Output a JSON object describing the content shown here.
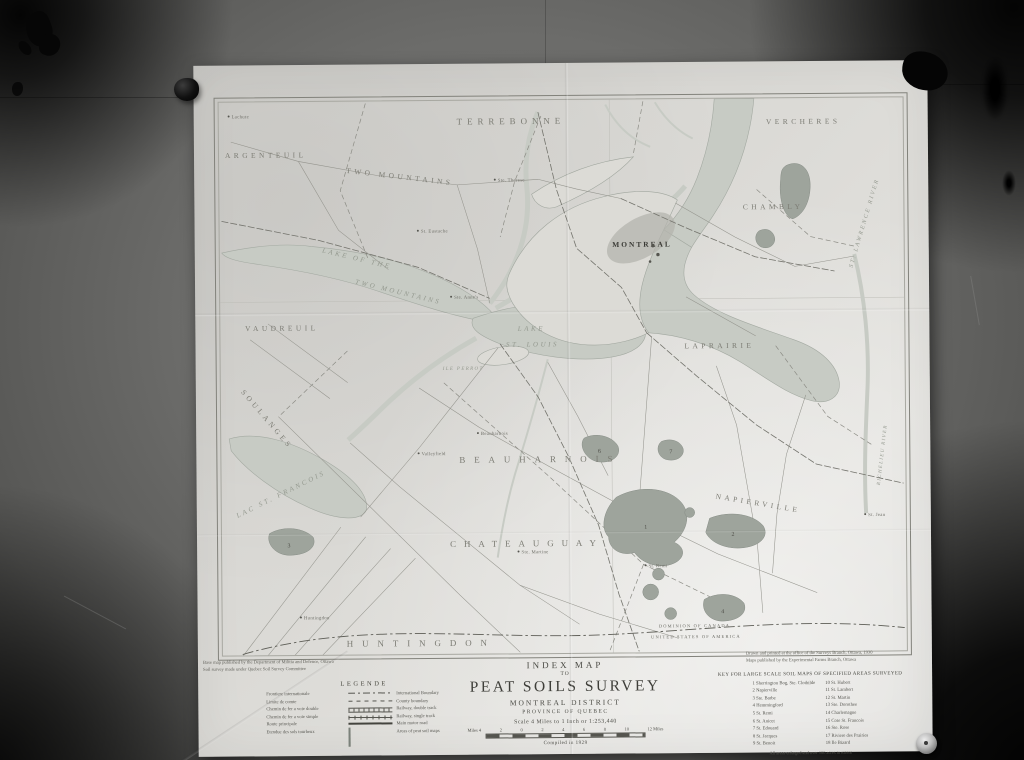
{
  "photo": {
    "wall_color": "#6c6c6a",
    "paper_color": "#dbdad6",
    "water_color": "#c7cbc4",
    "bog_color": "#9ea49c",
    "ink_color": "#4c4c46"
  },
  "map": {
    "labels": {
      "terrebonne": "TERREBONNE",
      "vercheres": "VERCHERES",
      "argenteuil": "ARGENTEUIL",
      "two_mountains": "TWO MOUNTAINS",
      "chambly": "CHAMBLY",
      "laprairie": "LAPRAIRIE",
      "vaudreuil": "VAUDREUIL",
      "soulanges": "SOULANGES",
      "beauharnois": "BEAUHARNOIS",
      "chateauguay": "CHATEAUGUAY",
      "huntingdon": "HUNTINGDON",
      "napierville": "NAPIERVILLE",
      "lake_two_mountains_1": "LAKE OF THE",
      "lake_two_mountains_2": "TWO MOUNTAINS",
      "lake_st_louis_1": "LAKE",
      "lake_st_louis_2": "ST. LOUIS",
      "lac_st_francois": "LAC ST. FRANCOIS",
      "ile_perrot": "ILE PERROT",
      "st_lawrence_river": "ST. LAWRENCE RIVER",
      "richelieu_river": "RICHELIEU RIVER",
      "montreal": "MONTREAL",
      "boundary_north": "DOMINION OF CANADA",
      "boundary_south": "UNITED STATES OF AMERICA"
    },
    "towns": [
      "Lachute",
      "Ste. Therese",
      "St. Eustache",
      "Ste. Anne's",
      "Valleyfield",
      "Beauharnois",
      "Ste. Martine",
      "Huntingdon",
      "St. Remi",
      "St. Jean"
    ],
    "bog_numbers": [
      "1",
      "2",
      "3",
      "4",
      "6",
      "7"
    ]
  },
  "title_block": {
    "line1": "INDEX MAP",
    "line2": "TO",
    "line3": "PEAT SOILS SURVEY",
    "line4": "MONTREAL DISTRICT",
    "line5": "PROVINCE OF QUEBEC",
    "scale_text": "Scale 4 Miles to 1 Inch or 1:253,440",
    "scale_left": "Miles 4",
    "scale_ticks": [
      "2",
      "0",
      "2",
      "4",
      "6",
      "8",
      "10"
    ],
    "scale_right": "12 Miles",
    "compiled": "Compiled in 1929"
  },
  "legend": {
    "title": "LEGENDE",
    "rows": [
      {
        "fr": "Frontiere internationale",
        "en": "International Boundary"
      },
      {
        "fr": "Limite de comte",
        "en": "County boundary"
      },
      {
        "fr": "Chemin de fer a voie double",
        "en": "Railway, double track"
      },
      {
        "fr": "Chemin de fer a voie simple",
        "en": "Railway, single track"
      },
      {
        "fr": "Route principale",
        "en": "Main motor road"
      },
      {
        "fr": "Etendue des sols tourbeux",
        "en": "Areas of peat soil maps"
      }
    ]
  },
  "key": {
    "title": "KEY FOR LARGE SCALE SOIL MAPS OF SPECIFIED AREAS SURVEYED",
    "items_left": [
      "1  Sherrington Bog, Ste. Clothilde",
      "2  Napierville",
      "3  Ste. Barbe",
      "4  Hemmingford",
      "5  St. Remi",
      "6  St. Anicet",
      "7  St. Edouard",
      "8  St. Jacques",
      "9  St. Benoit"
    ],
    "items_right": [
      "10  St. Hubert",
      "11  St. Lambert",
      "12  St. Martin",
      "13  Ste. Dorothee",
      "14  Charlemagne",
      "15  Cote St. Francois",
      "16  Ste. Rose",
      "17  Riviere des Prairies",
      "18  Ile Bizard"
    ],
    "footnote": "All areas enlarged and over 100 acres in extent"
  },
  "notes": {
    "bottom_left_1": "Base map published by the Department of Militia and Defence, Ottawa",
    "bottom_left_2": "Soil survey made under Quebec Soil Survey Committee",
    "bottom_right_1": "Drawn and printed at the office of the Surveys Branch, Ottawa, 1930",
    "bottom_right_2": "Maps published by the Experimental Farms Branch, Ottawa"
  }
}
